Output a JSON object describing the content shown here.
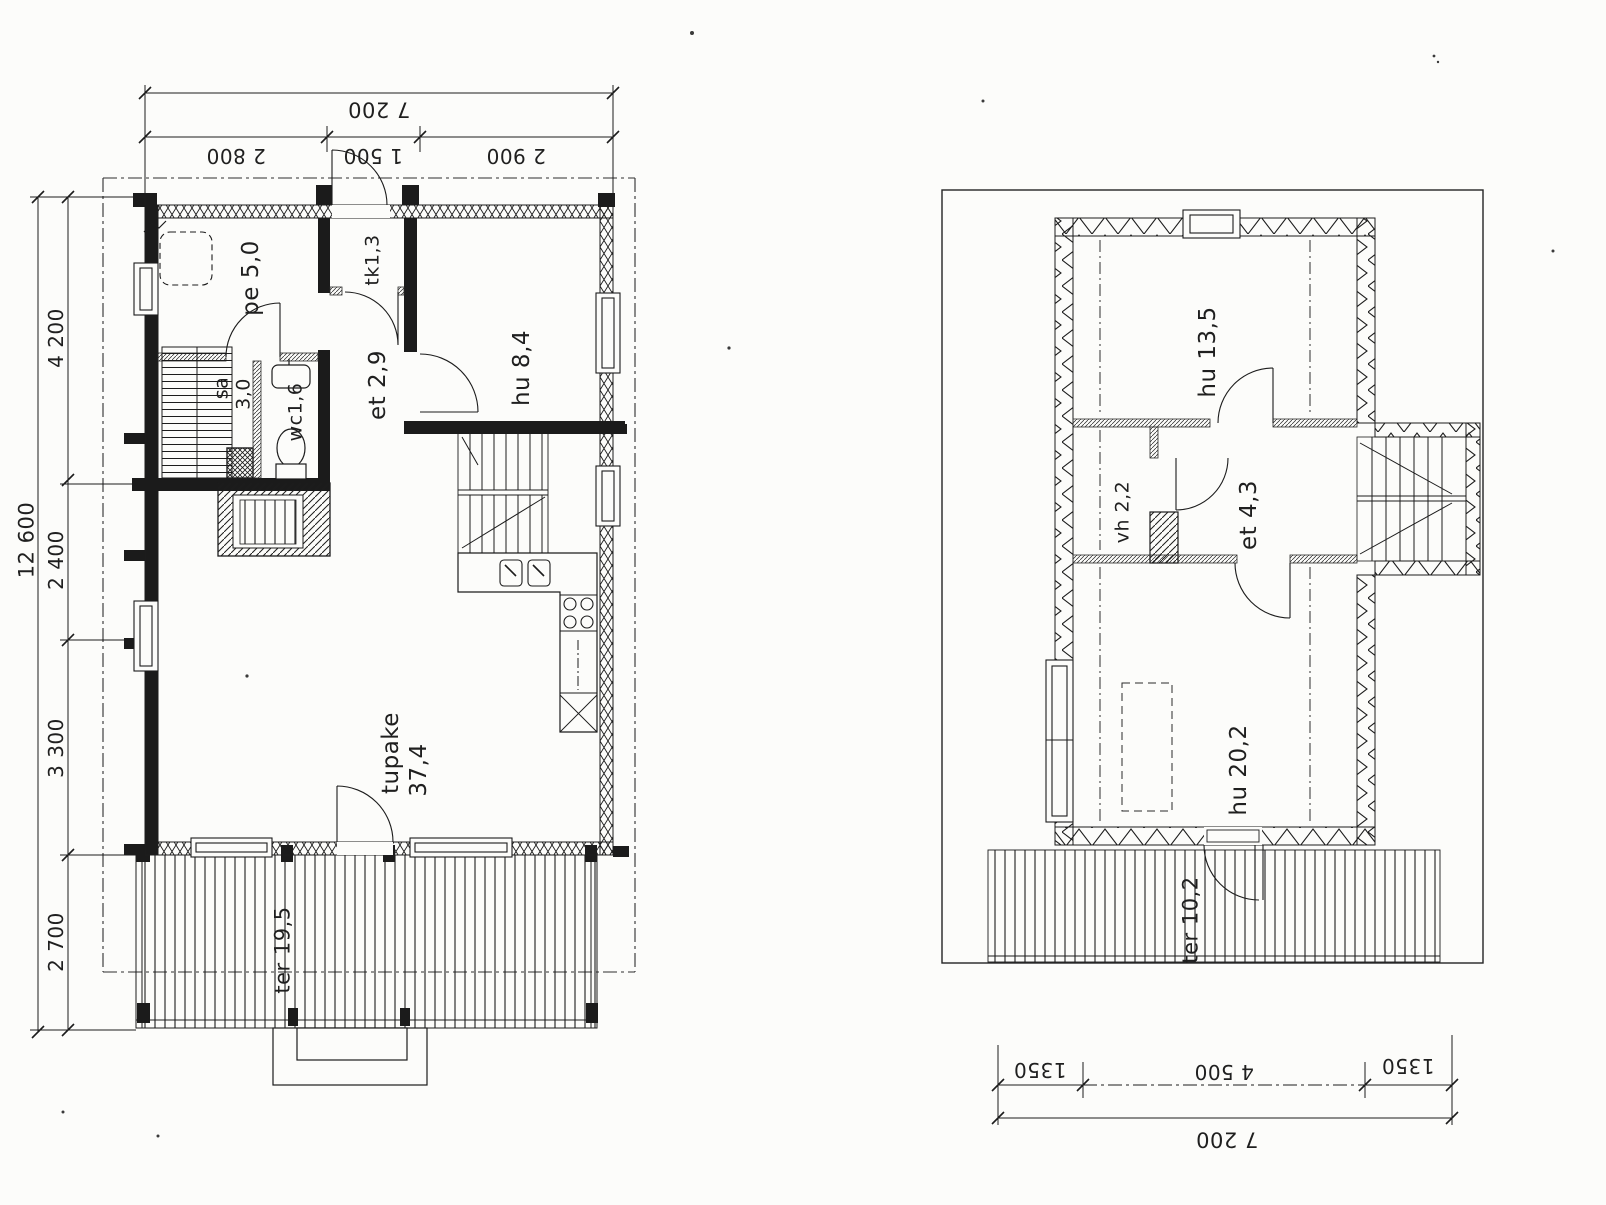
{
  "drawing": {
    "kind": "house floor plan, scanned architectural drawing",
    "ink_color": "#1c1c1c",
    "paper_color": "#fcfcfa"
  },
  "ground_floor": {
    "rooms": {
      "pe": "pe 5,0",
      "sa": "sa",
      "sa_area": "3,0",
      "wc": "wc1,6",
      "tk": "tk1,3",
      "et": "et 2,9",
      "hu": "hu 8,4",
      "tupake": "tupake",
      "tupake_area": "37,4",
      "terrace": "ter 19,5"
    },
    "dimensions": {
      "top_total": "7 200",
      "top_seg1": "2 800",
      "top_seg2": "1 500",
      "top_seg3": "2 900",
      "left_total": "12 600",
      "left_seg1": "4 200",
      "left_seg2": "2 400",
      "left_seg3": "3 300",
      "left_seg4": "2 700"
    }
  },
  "upper_floor": {
    "rooms": {
      "hu2": "hu 13,5",
      "vh": "vh 2,2",
      "et2": "et 4,3",
      "hu3": "hu 20,2",
      "terrace2": "ter 10,2"
    },
    "dimensions": {
      "bottom_seg1": "1350",
      "bottom_seg2": "4 500",
      "bottom_seg3": "1350",
      "bottom_total": "7 200"
    }
  }
}
